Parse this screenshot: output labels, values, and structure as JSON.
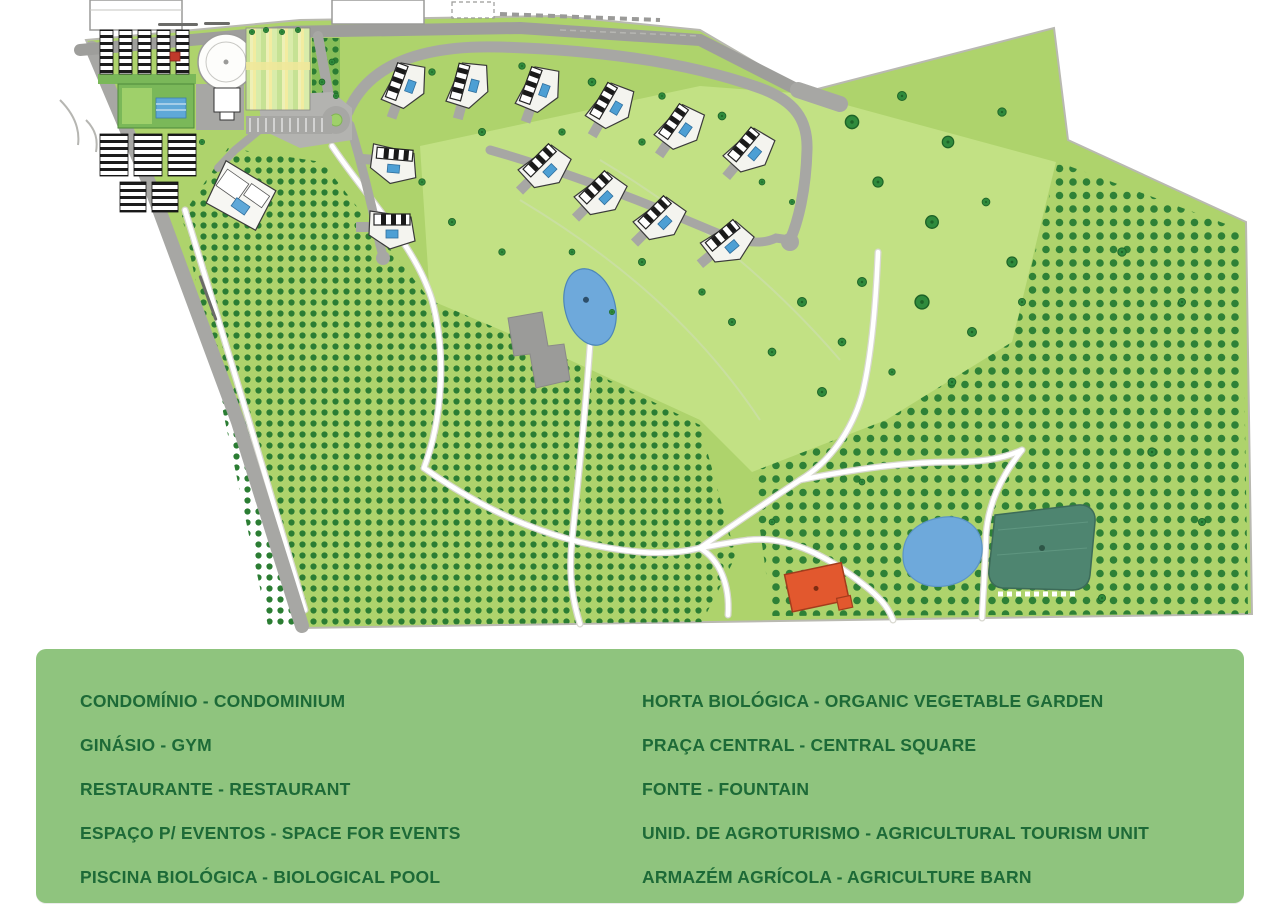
{
  "legend": {
    "left": [
      "CONDOMÍNIO - CONDOMINIUM",
      "GINÁSIO - GYM",
      "RESTAURANTE - RESTAURANT",
      "ESPAÇO P/ EVENTOS - SPACE FOR EVENTS",
      "PISCINA BIOLÓGICA - BIOLOGICAL POOL"
    ],
    "right": [
      "HORTA BIOLÓGICA - ORGANIC VEGETABLE GARDEN",
      "PRAÇA CENTRAL - CENTRAL SQUARE",
      "FONTE - FOUNTAIN",
      "UNID. DE AGROTURISMO - AGRICULTURAL TOURISM UNIT",
      "ARMAZÉM AGRÍCOLA - AGRICULTURE BARN"
    ]
  },
  "colors": {
    "legend_background": "#8fc47e",
    "legend_text": "#1d6a37",
    "field_green": "#aed36c",
    "field_light_green": "#c2e184",
    "orchard_dot_green": "#2b7d33",
    "road_gray": "#a7a7a4",
    "path_white": "#ffffff",
    "pond_blue": "#6ea9db",
    "pool_blue": "#4d9fd4",
    "reservoir_teal": "#4e8570",
    "barn_orange": "#e2582e"
  }
}
